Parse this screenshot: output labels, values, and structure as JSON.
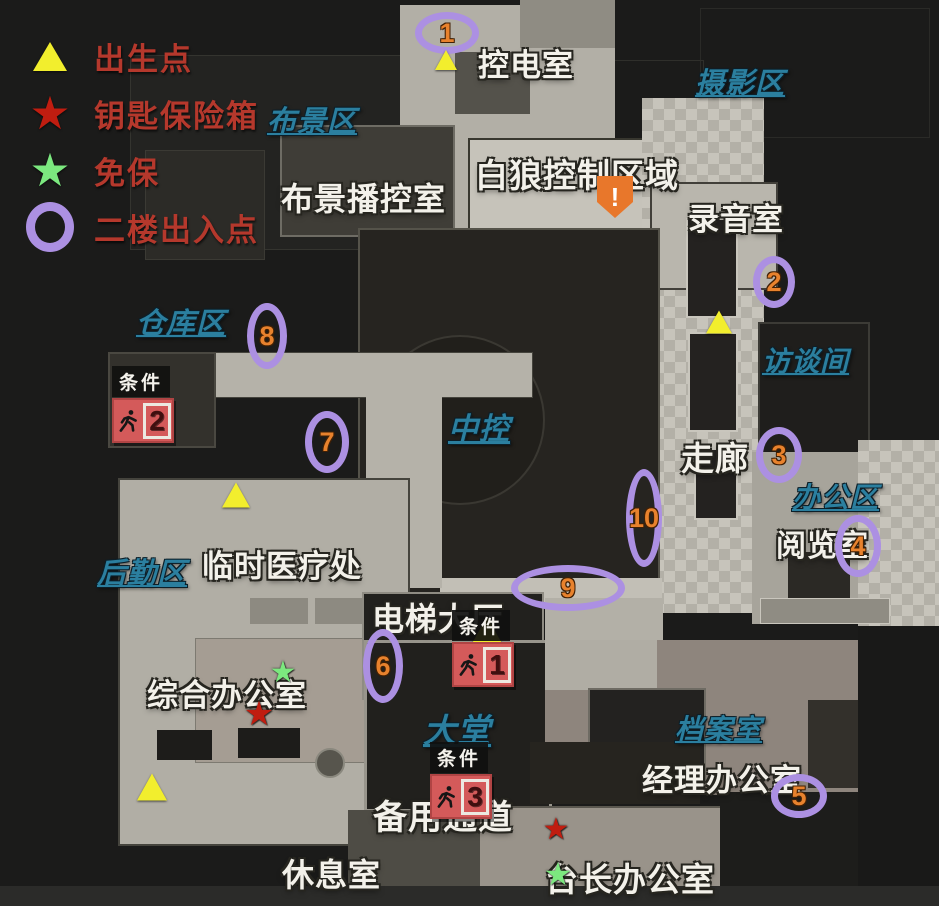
{
  "map": {
    "legend": {
      "items": [
        {
          "type": "spawn",
          "label": "出生点"
        },
        {
          "type": "key-safe",
          "label": "钥匙保险箱"
        },
        {
          "type": "free-safe",
          "label": "免保"
        },
        {
          "type": "floor2",
          "label": "二楼出入点"
        }
      ]
    },
    "area_labels": [
      {
        "text": "摄影区",
        "x": 695,
        "y": 60,
        "size": 29
      },
      {
        "text": "布景区",
        "x": 267,
        "y": 98,
        "size": 29
      },
      {
        "text": "仓库区",
        "x": 136,
        "y": 300,
        "size": 29
      },
      {
        "text": "访谈间",
        "x": 762,
        "y": 340,
        "size": 28
      },
      {
        "text": "中控",
        "x": 448,
        "y": 404,
        "size": 30
      },
      {
        "text": "办公区",
        "x": 792,
        "y": 476,
        "size": 28
      },
      {
        "text": "后勤区",
        "x": 97,
        "y": 550,
        "size": 29
      },
      {
        "text": "大堂",
        "x": 423,
        "y": 704,
        "size": 33
      },
      {
        "text": "档案室",
        "x": 675,
        "y": 708,
        "size": 28
      }
    ],
    "room_labels": [
      {
        "text": "控电室",
        "x": 478,
        "y": 40,
        "size": 31
      },
      {
        "text": "布景播控室",
        "x": 281,
        "y": 174,
        "size": 32
      },
      {
        "text": "白狼控制区域",
        "x": 475,
        "y": 149,
        "size": 33
      },
      {
        "text": "录音室",
        "x": 688,
        "y": 194,
        "size": 31
      },
      {
        "text": "走廊",
        "x": 681,
        "y": 432,
        "size": 33
      },
      {
        "text": "阅览室",
        "x": 776,
        "y": 521,
        "size": 30
      },
      {
        "text": "临时医疗处",
        "x": 202,
        "y": 541,
        "size": 31
      },
      {
        "text": "电梯大厅",
        "x": 372,
        "y": 594,
        "size": 32
      },
      {
        "text": "综合办公室",
        "x": 147,
        "y": 670,
        "size": 31
      },
      {
        "text": "经理办公室",
        "x": 642,
        "y": 755,
        "size": 31
      },
      {
        "text": "备用通道",
        "x": 373,
        "y": 790,
        "size": 34
      },
      {
        "text": "台长办公室",
        "x": 545,
        "y": 853,
        "size": 33
      },
      {
        "text": "休息室",
        "x": 282,
        "y": 850,
        "size": 32
      }
    ],
    "floor2_points": [
      {
        "n": "1",
        "cx": 447,
        "cy": 33,
        "rx": 32,
        "ry": 21
      },
      {
        "n": "2",
        "cx": 774,
        "cy": 282,
        "rx": 21,
        "ry": 26
      },
      {
        "n": "3",
        "cx": 779,
        "cy": 455,
        "rx": 23,
        "ry": 28
      },
      {
        "n": "4",
        "cx": 858,
        "cy": 546,
        "rx": 23,
        "ry": 31
      },
      {
        "n": "5",
        "cx": 799,
        "cy": 796,
        "rx": 28,
        "ry": 22
      },
      {
        "n": "6",
        "cx": 383,
        "cy": 666,
        "rx": 20,
        "ry": 37
      },
      {
        "n": "7",
        "cx": 327,
        "cy": 442,
        "rx": 22,
        "ry": 31
      },
      {
        "n": "8",
        "cx": 267,
        "cy": 336,
        "rx": 20,
        "ry": 33
      },
      {
        "n": "9",
        "cx": 568,
        "cy": 588,
        "rx": 57,
        "ry": 23
      },
      {
        "n": "10",
        "cx": 644,
        "cy": 518,
        "rx": 18,
        "ry": 49
      }
    ],
    "spawn_points": [
      {
        "x": 446,
        "y": 60,
        "size": 22
      },
      {
        "x": 719,
        "y": 322,
        "size": 26
      },
      {
        "x": 236,
        "y": 495,
        "size": 28
      },
      {
        "x": 487,
        "y": 630,
        "size": 30
      },
      {
        "x": 152,
        "y": 787,
        "size": 30
      }
    ],
    "key_safes": [
      {
        "x": 259,
        "y": 714,
        "size": 34
      },
      {
        "x": 556,
        "y": 830,
        "size": 30
      }
    ],
    "free_safes": [
      {
        "x": 283,
        "y": 673,
        "size": 30
      },
      {
        "x": 558,
        "y": 874,
        "size": 32
      }
    ],
    "exit_points": [
      {
        "number": "2",
        "label": "条件",
        "x": 112,
        "y": 366
      },
      {
        "number": "1",
        "label": "条件",
        "x": 452,
        "y": 610
      },
      {
        "number": "3",
        "label": "条件",
        "x": 430,
        "y": 742
      }
    ],
    "warning_marker": {
      "x": 597,
      "y": 176,
      "symbol": "!"
    },
    "colors": {
      "floor2_ring": "#ac90e2",
      "floor2_number": "#e8822d",
      "spawn": "#f2ee2d",
      "key_safe": "#c01d10",
      "free_safe": "#7ce87f",
      "area_label": "#2b7f9f",
      "room_label": "#f3f1ea",
      "legend_text": "#b5382c",
      "warning": "#e8772b"
    }
  }
}
